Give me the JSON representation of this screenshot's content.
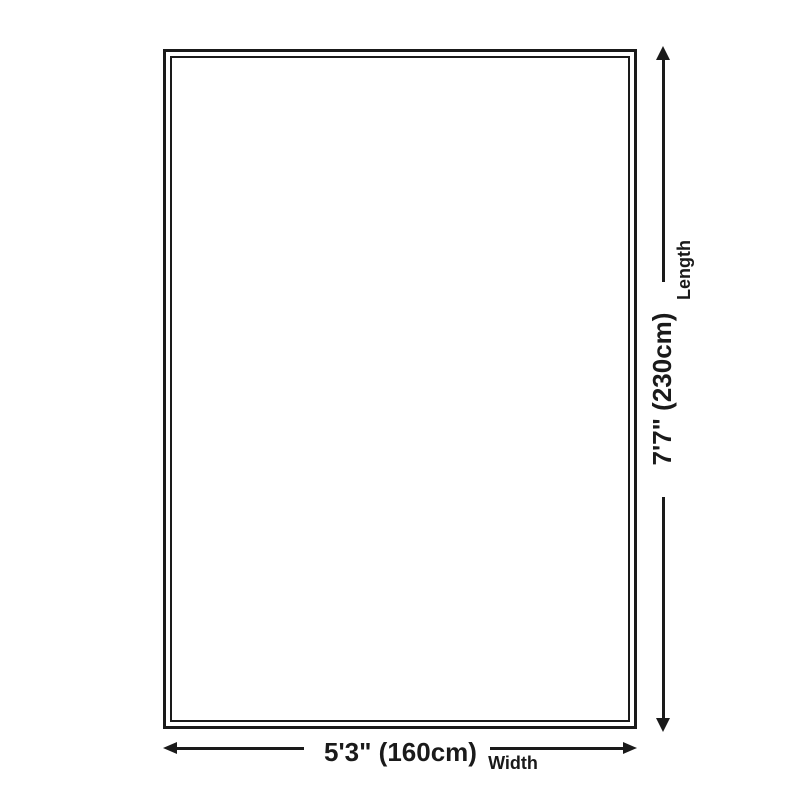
{
  "page": {
    "background_color": "#ffffff",
    "ink_color": "#1a1a1a"
  },
  "diagram": {
    "type": "product-dimension-diagram",
    "shape": "rectangle-double-border",
    "length": {
      "value": "7'7\" (230cm)",
      "label": "Length",
      "orientation": "vertical",
      "arrow": "double-headed"
    },
    "width": {
      "value": "5'3\" (160cm)",
      "label": "Width",
      "orientation": "horizontal",
      "arrow": "double-headed"
    }
  }
}
